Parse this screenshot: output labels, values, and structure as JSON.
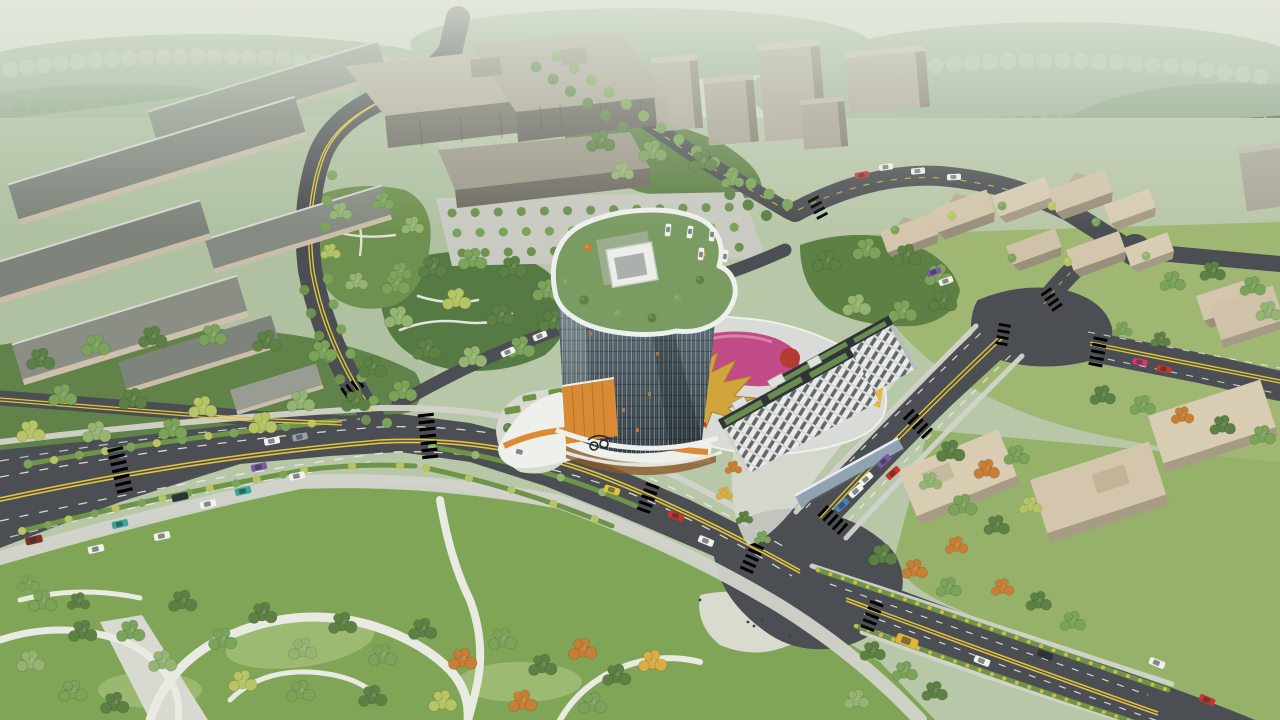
{
  "meta": {
    "title": "Aerial architectural rendering — curved glass tower and retail podium at an urban crossroads",
    "style": "photorealistic CG bird's-eye view, hazy daylight, no text or UI overlays",
    "image_size": "1280x720"
  },
  "palette": {
    "haze_top": "#dde3d6",
    "haze_low": "#c7d2c0",
    "ground_base": "#b9c7a9",
    "distant_forest": "#a2b498",
    "asphalt": "#4b4e52",
    "asphalt_light": "#55585c",
    "sidewalk": "#d3d4cc",
    "promenade": "#dadbd3",
    "park_path": "#e9eae2",
    "lane_white": "#eff0ea",
    "lane_yellow": "#e0c43c",
    "median_green": "#6f9349",
    "shrub_yellow": "#c9c23f",
    "park_grass": "#80a557",
    "lawn_light": "#a3bf78",
    "east_lawn": "#9cb56d",
    "campus_ground": "#aebfa0",
    "tree_dark": "#42603a",
    "tree_mid": "#5d8045",
    "tree_light": "#7ba35a",
    "tree_pale": "#95b472",
    "tree_yellow": "#b6c465",
    "tree_autumn": "#c77f35",
    "tree_gold": "#d8ae45",
    "campus_roof": "#7e837c",
    "campus_wall": "#cabeaa",
    "bigbox_roof": "#b5ae9f",
    "bigbox_wall": "#6e6a62",
    "netower_light": "#b0a89a",
    "netower_dark": "#847d70",
    "village_top": "#d3c6ac",
    "village_side": "#9a8f7a",
    "se_roof": "#d8ccb2",
    "tower_glass_top": "#5b6e76",
    "tower_glass_bottom": "#2a353d",
    "tower_frame": "#edf0ee",
    "tower_amber": "#d88a35",
    "roof_garden": "#7a9b62",
    "podium_white": "#eef0ec",
    "podium_orange": "#dd8a35",
    "podium_yellow": "#e2b93f",
    "podium_deck": "#d9dbd6",
    "roof_magenta": "#c04383",
    "roof_crimson": "#b53a35",
    "roof_gold": "#d2a43c",
    "slab_facade": "#e9ebe8",
    "slab_parapet": "#2f3438",
    "green_roof": "#6a8d4f",
    "canopy_blue": "#8fa3b3",
    "parking": "#c9cac2",
    "car_white": "#f1f2ee",
    "car_red": "#c8332e",
    "car_teal": "#38a79b",
    "car_blue": "#4a7fc0",
    "car_purple": "#7e57a8",
    "car_dark": "#30343a",
    "car_taxi": "#e3c43e",
    "bus_yellow": "#e0b63a",
    "car_magenta": "#d23a6e",
    "car_maroon": "#7a3028",
    "car_gray": "#9aa0a4"
  },
  "scene": {
    "landmark": {
      "tower": {
        "form": "curved organic-plan glass office tower",
        "roof": "rooftop garden with trees and a white mechanical penthouse inside a white parapet ribbon",
        "facade": "dense vertical white mullions over blue-grey curtain wall, scattered amber-lit windows",
        "base": "amber timber-slat band with curved white terrace ribbons"
      },
      "podium": {
        "use": "retail mall podium",
        "roofscape": [
          "magenta play blob",
          "gold dragon/phoenix sculpture",
          "red kiosks",
          "roof trees",
          "grey deck",
          "white pavilion"
        ],
        "east_facade": "mustard-yellow slats",
        "south_facade": "curved white bands with orange ribbon and storefront glazing"
      },
      "residential_slabs": {
        "count": 2,
        "facade": "white grid with dark window rows",
        "roof": "green roof strips behind dark parapet, small white rooftop boxes",
        "street_canopy": "blue-grey curved canopy"
      },
      "plaza": [
        "bicycle sculpture",
        "hedge planters",
        "pocket grove with paths",
        "pedestrians"
      ]
    },
    "districts": {
      "northwest_campus": {
        "type": "parallel industrial slabs, grey roofs, tan facades",
        "rows": 7
      },
      "north_complex": {
        "type": "large grey-tan office blocks with annex",
        "blocks": 3
      },
      "northeast_towers": {
        "type": "mid-rise grey-tan towers",
        "count": 5
      },
      "east_village": {
        "type": "faceted tan wedge houses in trees",
        "count": 9
      },
      "southeast_campus": {
        "type": "tan flat-roof blocks",
        "count": 4
      },
      "far_right_slab": {
        "type": "hazy residential slab at right edge",
        "count": 1
      }
    },
    "roads": {
      "boulevard": {
        "desc": "multi-lane dual carriageway west-to-center",
        "markings": [
          "double yellow centre",
          "white dashed lanes"
        ],
        "medians": "tree-planted",
        "cars": 15
      },
      "northwest_road": {
        "desc": "two-lane tree-lined curve to top edge",
        "cars": 0
      },
      "northeast_road": {
        "desc": "two-lane link from main crossing to east crossing",
        "cars": 5
      },
      "southeast_road": {
        "desc": "avenue to bottom-right with planted yellow-shrub verges",
        "cars": 5
      },
      "village_loop": {
        "desc": "local streets looping the village",
        "cars": 6
      },
      "rear_avenue": {
        "desc": "tree-lined avenue behind tower"
      },
      "service_ring": {
        "desc": "light service road along podium, with 2 cars"
      },
      "intersections": 5,
      "crosswalks": 12
    },
    "park": {
      "location": "bottom",
      "features": [
        "wide winding white paths",
        "bright lawns",
        "mixed tree clusters",
        "autumn accents",
        "small plaza with pedestrians"
      ]
    },
    "parking_lot": {
      "location": "north of tower",
      "tree_rows": 3,
      "parked_cars": 5
    },
    "vehicles_total": 40,
    "atmosphere": {
      "sky": "pale green haze band",
      "distance": "misty forest",
      "light": "soft daylight from upper left"
    }
  }
}
